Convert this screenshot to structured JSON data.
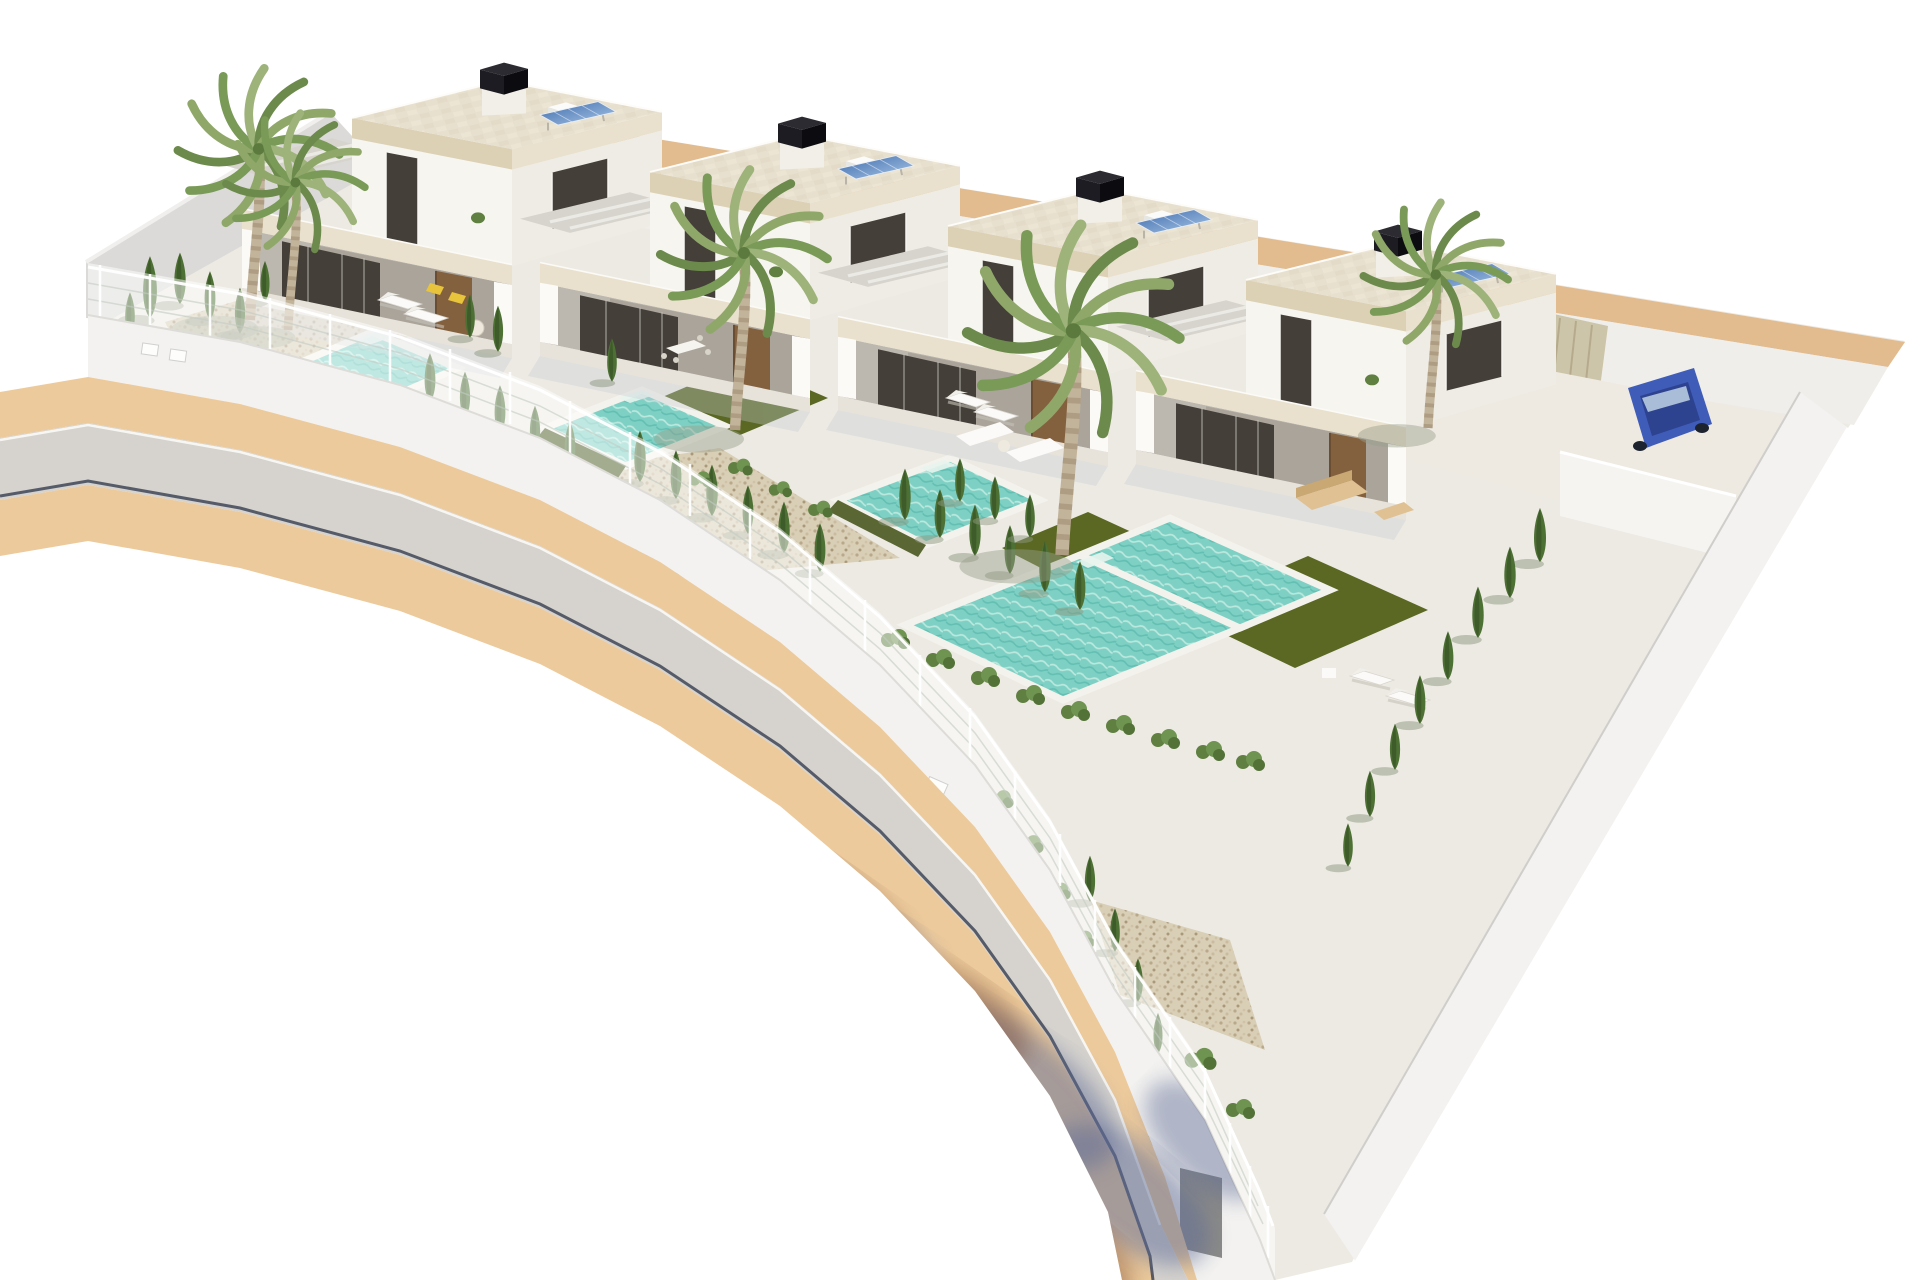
{
  "scene": {
    "description": "Aerial 3D architectural rendering of a row of four modern white flat-roof villas, each with a private turquoise pool, artificial lawn, gravel garden, cypress hedges and palm trees, bounded by a white fence-topped wall along a curved asphalt street with tan paver sidewalks; tree shadows fall across the road and a blue car is parked beside the last villa.",
    "style": "photorealistic CGI render on white background",
    "background": "#ffffff"
  },
  "inventory": {
    "villas": 4,
    "swimming_pools": 4,
    "palm_trees": 5,
    "cypress_trees": 38,
    "sun_loungers": 8,
    "outdoor_sofa_sets": 2,
    "dining_sets": 2,
    "solar_panels": 4,
    "chimneys": 4,
    "lawn_patches": 4,
    "gravel_beds": 3,
    "parked_cars": 1,
    "gates": 1,
    "utility_boxes": 4
  },
  "colors": {
    "background": "#ffffff",
    "road": "#d6d3ce",
    "sidewalk": "#ecca9c",
    "curb_line": "#3e4556",
    "wall_face": "#f3f2f0",
    "terrace": "#edeae3",
    "pool_water": "#7fd0c4",
    "pool_coping": "#f3f1ea",
    "lawn": "#5a6823",
    "lawn_dark": "#49581f",
    "gravel": "#d9cfb6",
    "roof_deck": "#e8e0cf",
    "fascia": "#dcd1b5",
    "fascia_light": "#e9e1cd",
    "villa_wall": "#f7f5f0",
    "villa_wall_shade": "#efece5",
    "window_glass": "#443f39",
    "door_wood": "#84613e",
    "chimney": "#1c1c22",
    "solar_blue": "#5c87c2",
    "palm_green": "#8fa86a",
    "palm_green_dark": "#6c8a4b",
    "cypress": "#4d7034",
    "cypress_dark": "#3b5827",
    "shrub": "#5f8040",
    "shadow_blue": "#5f6c96",
    "shadow_brown": "#7e4b33",
    "car_blue": "#3f5cb8",
    "rear_wall_top": "#e2bb8e",
    "gate_gray": "#8a8a88",
    "left_wall": "#dbdad8"
  }
}
